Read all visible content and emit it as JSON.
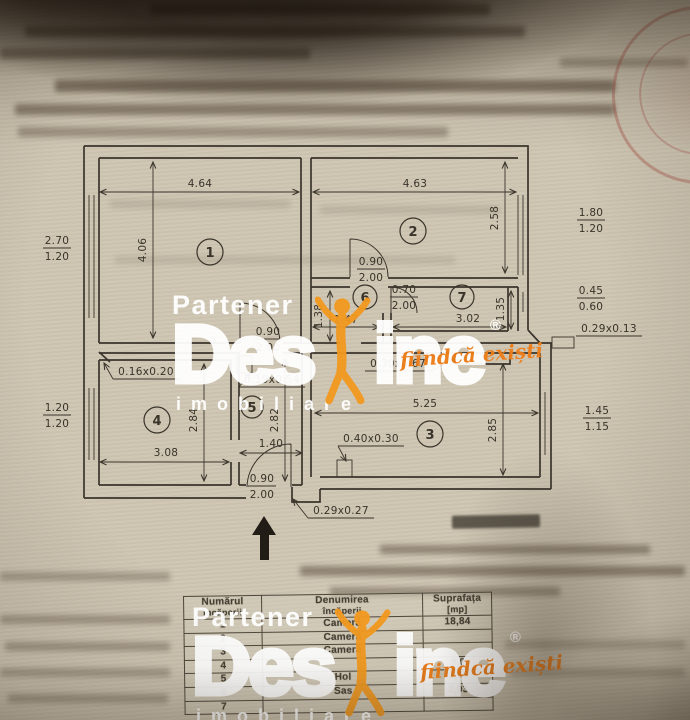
{
  "floor_plan": {
    "room_numbers": [
      "1",
      "2",
      "3",
      "4",
      "5",
      "6",
      "7"
    ],
    "dims": {
      "r1w": "4.64",
      "r1h": "4.06",
      "r2w": "4.63",
      "r2h": "2.58",
      "r3w": "5.25",
      "r3h": "2.85",
      "r4w": "3.08",
      "r4h": "2.84",
      "r5w": "1.40",
      "r5h": "2.82",
      "r6w": "1.47",
      "r6h": "1.38",
      "r7w": "3.02",
      "r7h": "1.35"
    },
    "fractions": {
      "win_left_r1": [
        "2.70",
        "1.20"
      ],
      "win_left_r4": [
        "1.20",
        "1.20"
      ],
      "win_right_r2": [
        "1.80",
        "1.20"
      ],
      "win_right_r7": [
        "0.45",
        "0.60"
      ],
      "win_right_r3": [
        "1.45",
        "1.15"
      ],
      "door_r2": [
        "0.90",
        "2.00"
      ],
      "door_r6r7": [
        "0.70",
        "2.00"
      ],
      "door_r1": [
        "0.90",
        "2.00"
      ],
      "door_entry": [
        "0.90",
        "2.00"
      ]
    },
    "labels": {
      "vent_r4": "0.16x0.20",
      "pillar_hall": "0.19x0.54",
      "niche_r7": "0.30x0.67",
      "pillar_r3": "0.40x0.30",
      "step_entry": "0.29x0.27",
      "vent_right": "0.29x0.13"
    }
  },
  "table": {
    "header": {
      "col1_line1": "Numărul",
      "col1_line2": "încăperii",
      "col2_line1": "Denumirea",
      "col2_line2": "încăperii",
      "col3_line1": "Suprafața",
      "col3_line2": "[mp]"
    },
    "rows": [
      {
        "num": "1",
        "name": "Cameră",
        "area": "18,84"
      },
      {
        "num": "2",
        "name": "Cameră",
        "area": ""
      },
      {
        "num": "3",
        "name": "Cameră",
        "area": ""
      },
      {
        "num": "4",
        "name": "",
        "area": "8,0"
      },
      {
        "num": "5",
        "name": "Hol",
        "area": "3,85"
      },
      {
        "num": "6",
        "name": "Sas",
        "area": "2,03"
      },
      {
        "num": "7",
        "name": "",
        "area": ""
      }
    ]
  },
  "watermark": {
    "partener": "Partener",
    "brand_left": "Des",
    "brand_right": "ine",
    "registered": "®",
    "tagline": "fiindcă exiști",
    "subtitle": "imobiliare",
    "orange": "#f2991f",
    "white": "#ffffff"
  }
}
